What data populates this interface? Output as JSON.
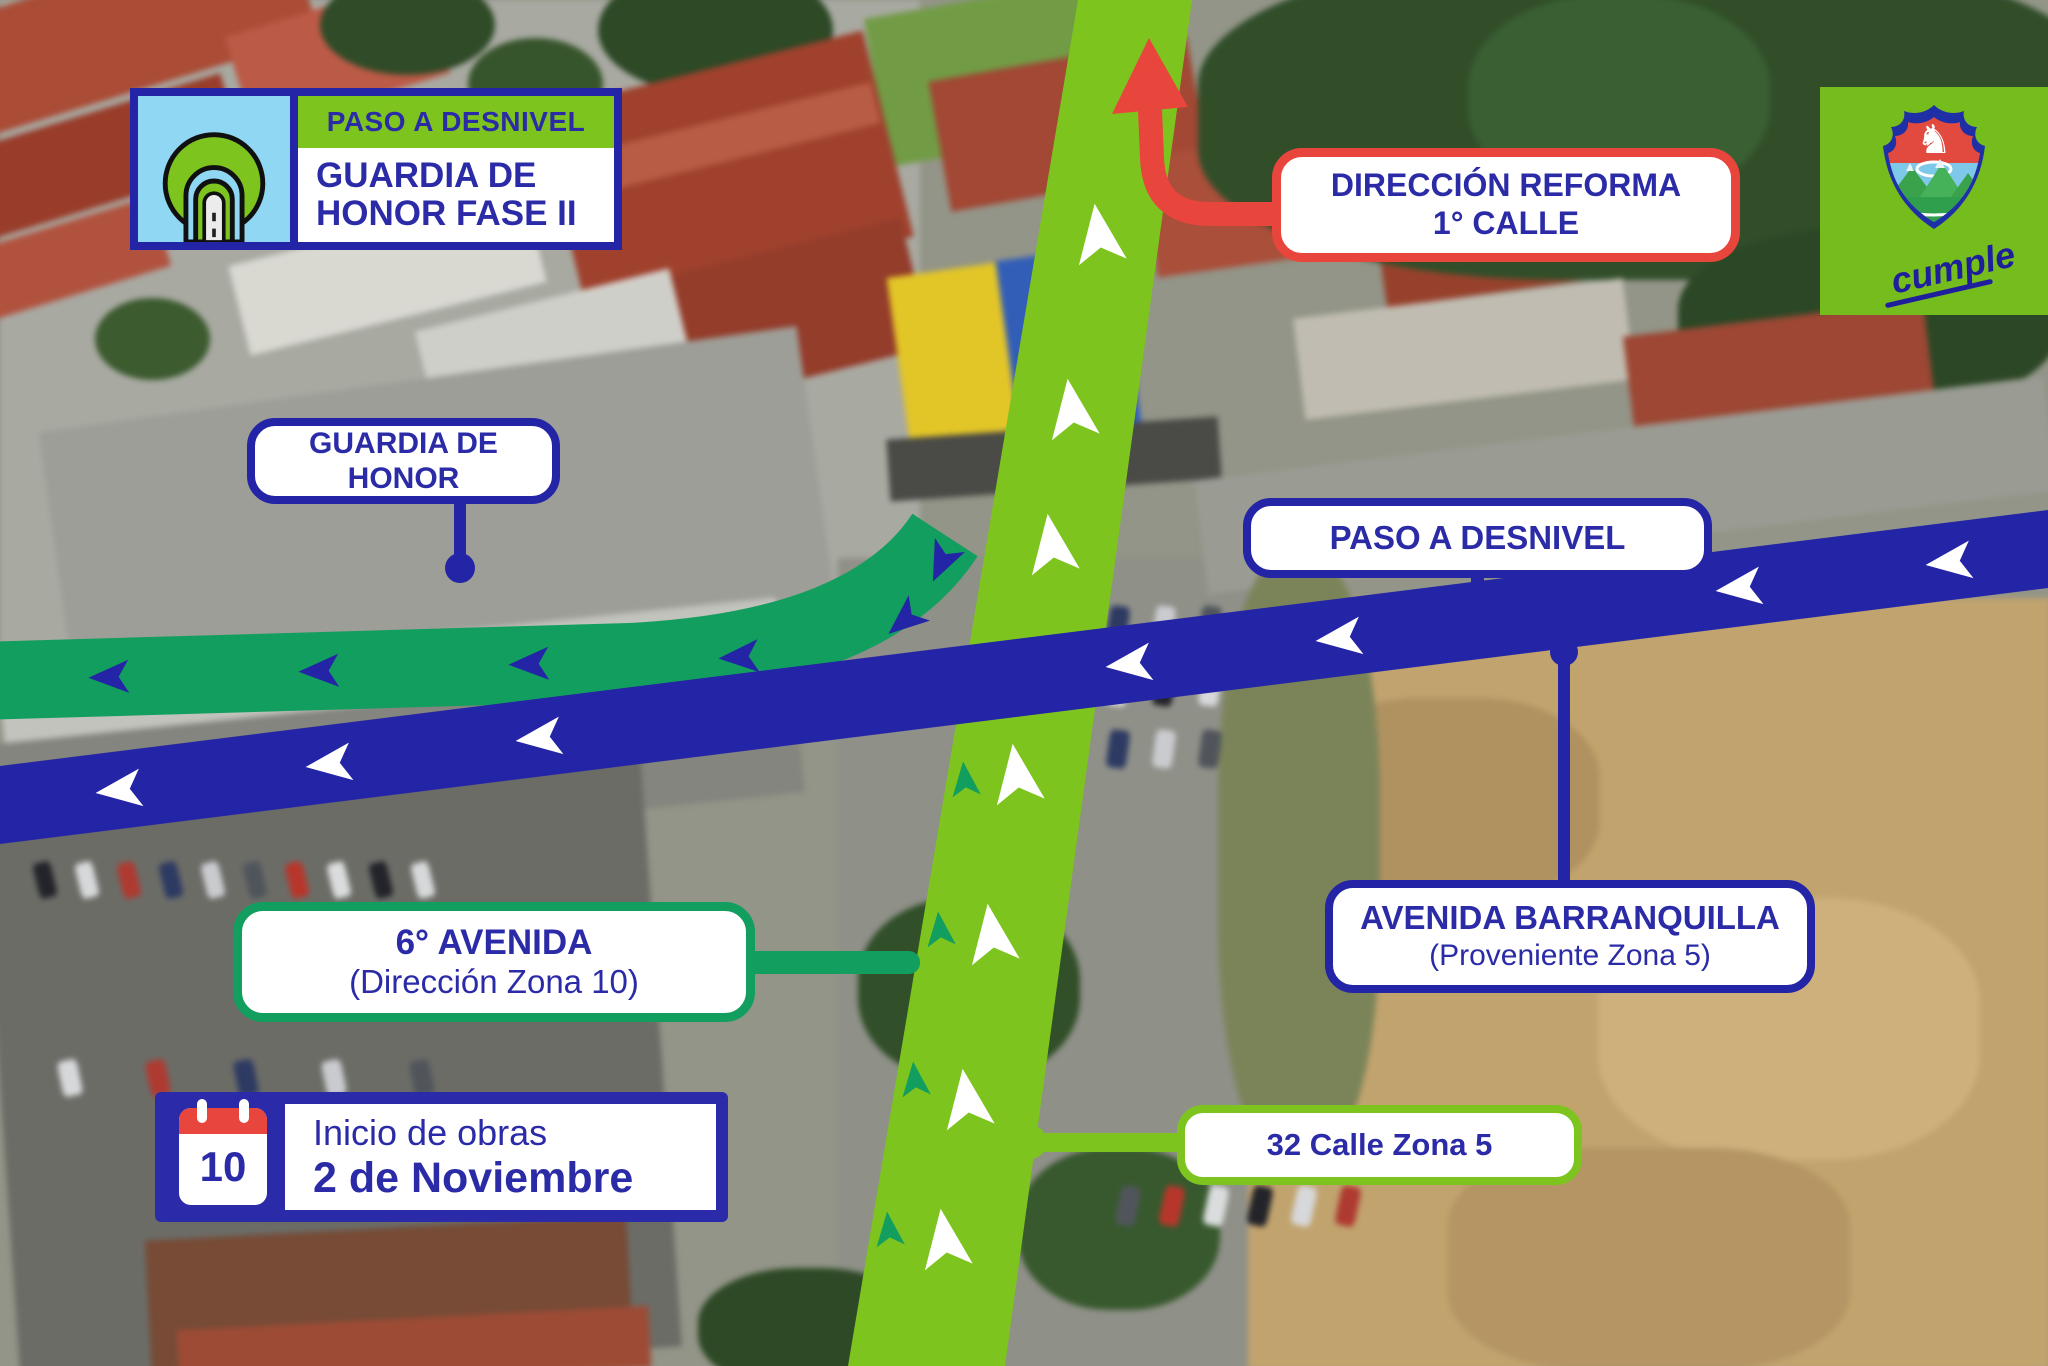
{
  "page": {
    "type": "traffic-advisory-map-infographic"
  },
  "colors": {
    "navy": "#2424a6",
    "text_navy": "#2b2ba8",
    "road_green": "#7dc41f",
    "road_teal": "#129e5e",
    "red": "#e8463d",
    "icon_bg_blue": "#8fd7f2",
    "logo_green": "#74bd1c",
    "label_bg": "#ffffff",
    "calendar_red": "#e8463d",
    "arrow_white": "#ffffff"
  },
  "badge": {
    "header": "PASO A DESNIVEL",
    "title_line1": "GUARDIA DE",
    "title_line2": "HONOR FASE II",
    "icon": "tunnel-icon"
  },
  "callouts": {
    "guardia_de_honor": {
      "text": "GUARDIA DE HONOR",
      "border": "navy"
    },
    "direccion_reforma": {
      "line1": "DIRECCIÓN REFORMA",
      "line2": "1° CALLE",
      "border": "red"
    },
    "paso_a_desnivel": {
      "text": "PASO A DESNIVEL",
      "border": "navy"
    },
    "avenida_barranquilla": {
      "line1": "AVENIDA BARRANQUILLA",
      "line2": "(Proveniente Zona 5)",
      "border": "navy"
    },
    "sexta_avenida": {
      "line1": "6° AVENIDA",
      "line2": "(Dirección Zona 10)",
      "border": "teal-green"
    },
    "calle_32": {
      "text": "32 Calle Zona 5",
      "border": "lime-green"
    }
  },
  "start_notice": {
    "calendar_day": "10",
    "line1": "Inicio de obras",
    "line2": "2 de Noviembre"
  },
  "logo": {
    "word": "cumple",
    "icon": "municipality-shield-icon"
  },
  "roads": {
    "green_road": {
      "arrow_direction": "up",
      "arrow_color": "white"
    },
    "teal_road": {
      "arrow_direction": "left",
      "arrow_color": "navy"
    },
    "blue_road": {
      "arrow_direction": "left",
      "arrow_color": "white"
    },
    "red_route": {
      "arrow_direction": "up",
      "refers_to": "direccion_reforma"
    }
  }
}
